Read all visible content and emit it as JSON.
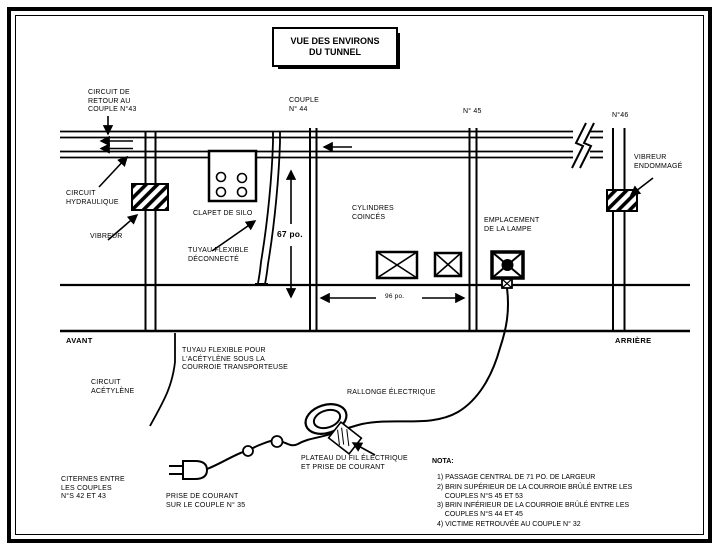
{
  "title": "VUE DES ENVIRONS\nDU TUNNEL",
  "labels": {
    "circuit_retour": "CIRCUIT DE\nRETOUR AU\nCOUPLE N°43",
    "couple_44": "COUPLE\nN° 44",
    "couple_45": "N° 45",
    "couple_46": "N°46",
    "vibreur_endommage": "VIBREUR\nENDOMMAGÉ",
    "circuit_hydraulique": "CIRCUIT\nHYDRAULIQUE",
    "vibreur": "VIBREUR",
    "clapet_de_silo": "CLAPET DE SILO",
    "tuyau_deconnecte": "TUYAU FLEXIBLE\nDÉCONNECTÉ",
    "dim_67": "67 po.",
    "dim_96": "96 po.",
    "cylindres_coinces": "CYLINDRES\nCOINCÉS",
    "emplacement_lampe": "EMPLACEMENT\nDE LA LAMPE",
    "avant": "AVANT",
    "arriere": "ARRIÈRE",
    "tuyau_acetylene": "TUYAU FLEXIBLE POUR\nL'ACÉTYLÈNE SOUS LA\nCOURROIE TRANSPORTEUSE",
    "circuit_acetylene": "CIRCUIT\nACÉTYLÈNE",
    "rallonge_electrique": "RALLONGE ÉLECTRIQUE",
    "plateau": "PLATEAU DU FIL ÉLECTRIQUE\nET PRISE DE COURANT",
    "citernes": "CITERNES ENTRE\nLES COUPLES\nN°S 42 ET 43",
    "prise_courant": "PRISE DE COURANT\nSUR LE COUPLE N° 35"
  },
  "notes": {
    "title": "NOTA:",
    "items": [
      "1) PASSAGE CENTRAL DE 71 PO. DE LARGEUR",
      "2) BRIN SUPÉRIEUR DE LA COURROIE BRÛLÉ ENTRE LES\n    COUPLES N°S 45 ET 53",
      "3) BRIN INFÉRIEUR DE LA COURROIE BRÛLÉ ENTRE LES\n    COUPLES N°S 44 ET 45",
      "4) VICTIME RETROUVÉE AU COUPLE N° 32"
    ]
  },
  "colors": {
    "ink": "#000000",
    "paper": "#ffffff"
  }
}
